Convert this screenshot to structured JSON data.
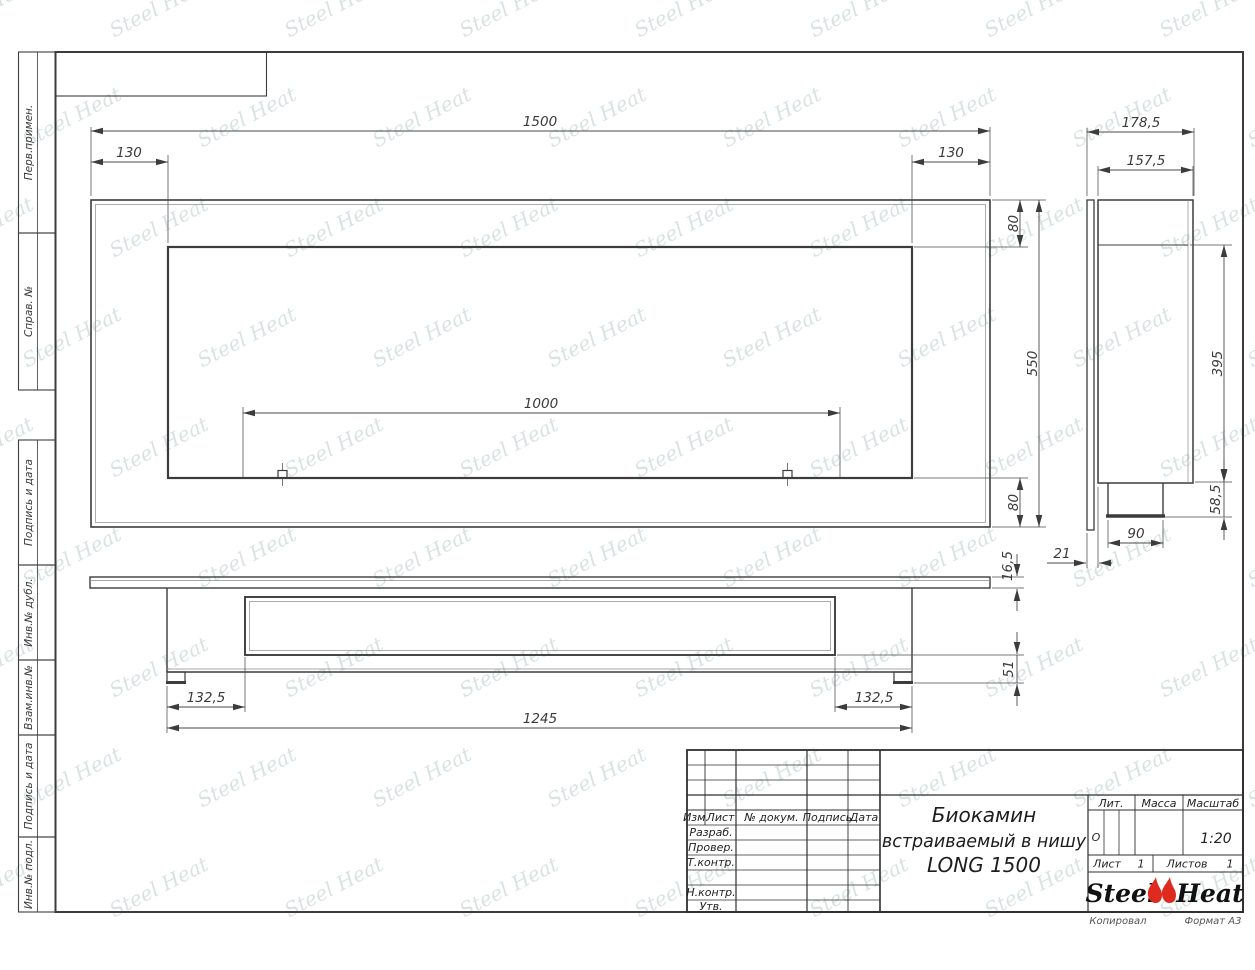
{
  "watermark": {
    "text": "Steel Heat"
  },
  "margin_labels": [
    "Перв.примен.",
    "Справ. №",
    "Подпись и дата",
    "Инв.№ дубл.",
    "Взам.инв.№",
    "Подпись и дата",
    "Инв.№ подл."
  ],
  "dims": {
    "front_total": "1500",
    "front_left": "130",
    "front_right": "130",
    "front_top": "80",
    "front_height": "550",
    "front_bottom": "80",
    "front_burner": "1000",
    "side_total_depth": "178,5",
    "side_body_depth": "157,5",
    "side_niche_height": "395",
    "side_burner_drop": "58,5",
    "side_burner_width": "90",
    "side_flange_offset": "21",
    "bottom_plate_thickness": "16,5",
    "bottom_front_offset": "51",
    "bottom_left_offset": "132,5",
    "bottom_right_offset": "132,5",
    "bottom_body_width": "1245"
  },
  "title_block": {
    "columns": [
      "Изм.",
      "Лист",
      "№ докум.",
      "Подпись",
      "Дата"
    ],
    "roles": [
      "Разраб.",
      "Провер.",
      "Т.контр.",
      "Н.контр.",
      "Утв."
    ],
    "title_lines": [
      "Биокамин",
      "встраиваемый в нишу",
      "LONG 1500"
    ],
    "lit_header": "Лит.",
    "lit_value": "О",
    "mass_header": "Масса",
    "scale_header": "Масштаб",
    "scale_value": "1:20",
    "sheet_label": "Лист",
    "sheet_value": "1",
    "sheets_label": "Листов",
    "sheets_value": "1",
    "logo_left": "Steel",
    "logo_right": "Heat",
    "footer_copy": "Копировал",
    "footer_format": "Формат А3"
  }
}
